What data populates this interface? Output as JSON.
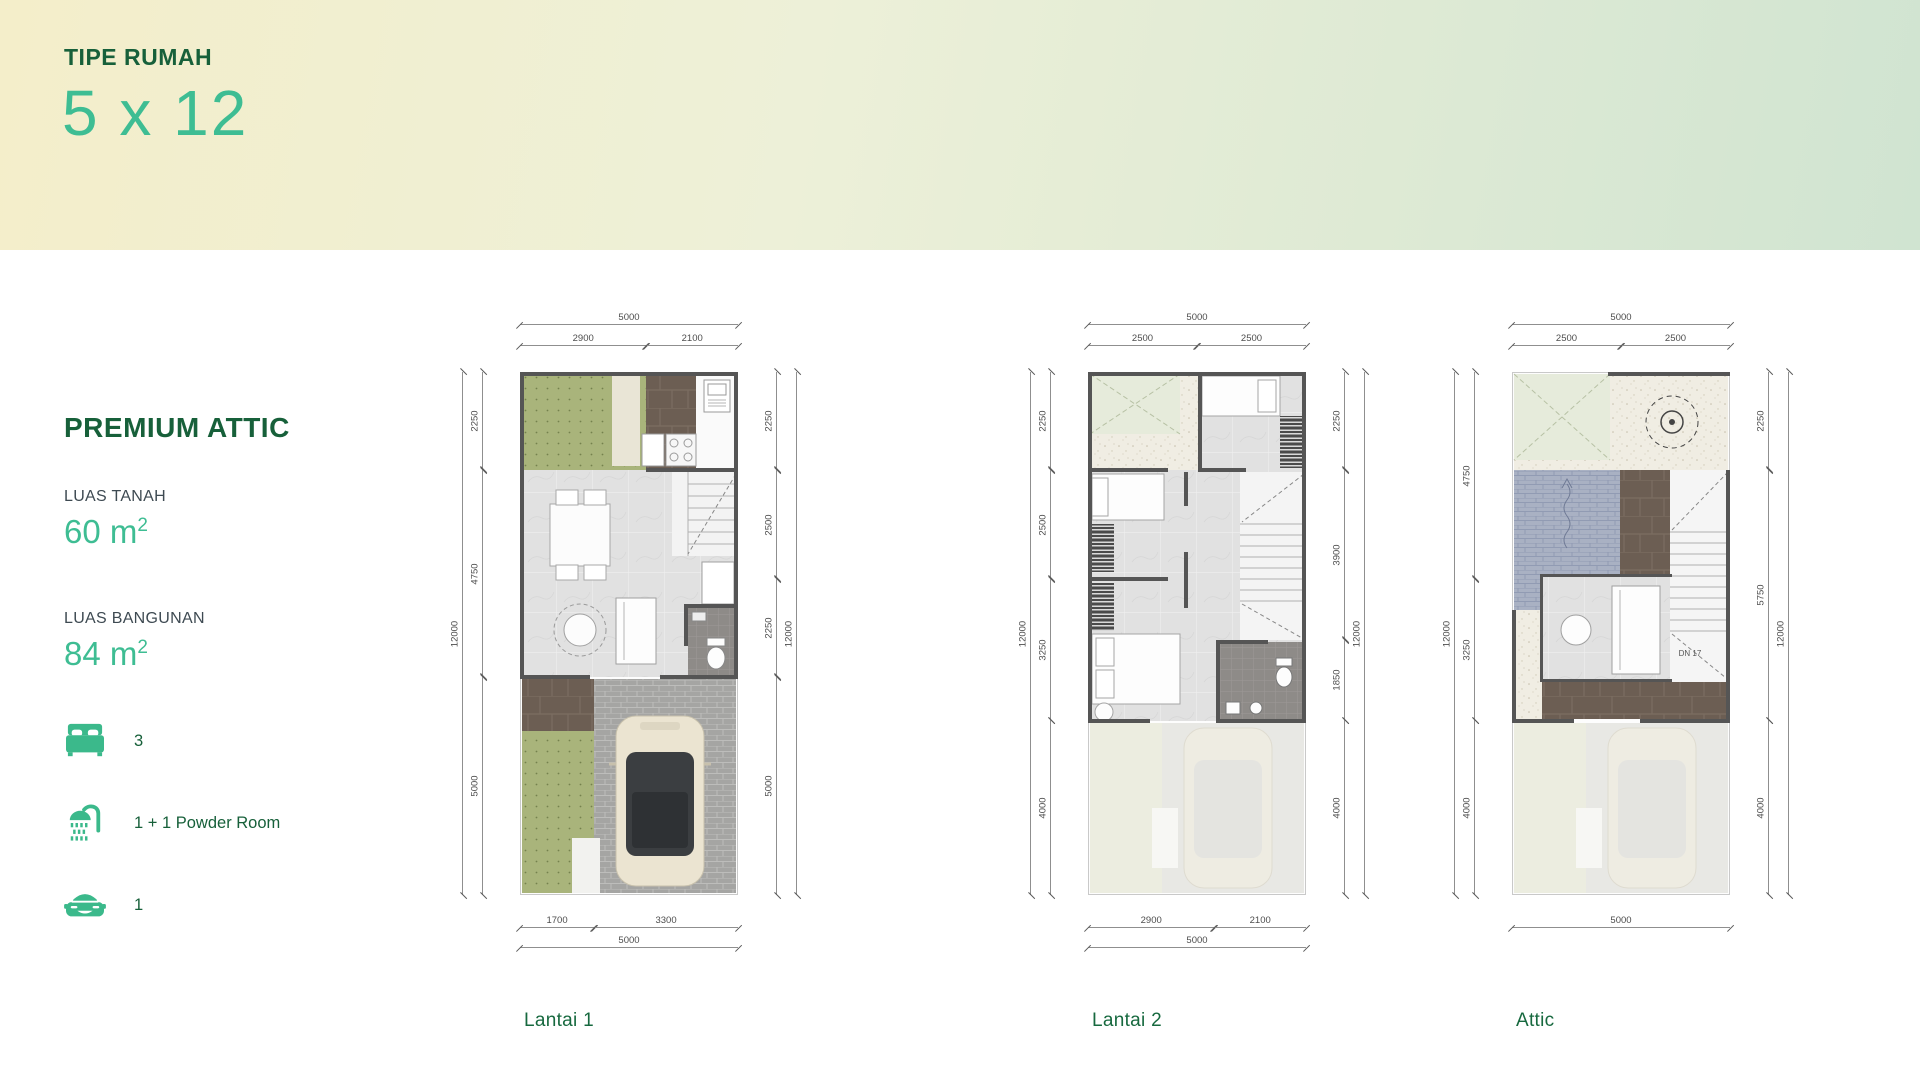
{
  "hero": {
    "eyebrow": "TIPE RUMAH",
    "title": "5 x 12"
  },
  "colors": {
    "dark_green": "#17603a",
    "teal": "#3ebd93",
    "icon_teal": "#3bb98b",
    "hero_gradient_left": "#f4eeca",
    "hero_gradient_right": "#d0e4d1"
  },
  "sidebar": {
    "title": "PREMIUM ATTIC",
    "specs": [
      {
        "label": "LUAS TANAH",
        "value": "60",
        "unit_base": "m",
        "unit_sup": "2"
      },
      {
        "label": "LUAS BANGUNAN",
        "value": "84",
        "unit_base": "m",
        "unit_sup": "2"
      }
    ],
    "features": [
      {
        "icon": "bed-icon",
        "label": "3"
      },
      {
        "icon": "shower-icon",
        "label": "1 + 1 Powder Room"
      },
      {
        "icon": "car-icon",
        "label": "1"
      }
    ]
  },
  "plans": [
    {
      "caption": "Lantai 1",
      "width_mm": 5000,
      "height_mm": 12000,
      "dims": {
        "top": {
          "total": "5000",
          "segments": [
            {
              "label": "2900",
              "mm": 2900
            },
            {
              "label": "2100",
              "mm": 2100
            }
          ]
        },
        "bottom": {
          "total": "5000",
          "segments": [
            {
              "label": "1700",
              "mm": 1700
            },
            {
              "label": "3300",
              "mm": 3300
            }
          ]
        },
        "left": {
          "total": "12000",
          "segments": [
            {
              "label": "2250",
              "mm": 2250
            },
            {
              "label": "4750",
              "mm": 4750
            },
            {
              "label": "5000",
              "mm": 5000
            }
          ]
        },
        "right": {
          "total": "12000",
          "segments": [
            {
              "label": "2250",
              "mm": 2250
            },
            {
              "label": "2500",
              "mm": 2500
            },
            {
              "label": "2250",
              "mm": 2250
            },
            {
              "label": "5000",
              "mm": 5000
            }
          ]
        }
      }
    },
    {
      "caption": "Lantai 2",
      "width_mm": 5000,
      "height_mm": 12000,
      "dims": {
        "top": {
          "total": "5000",
          "segments": [
            {
              "label": "2500",
              "mm": 2500
            },
            {
              "label": "2500",
              "mm": 2500
            }
          ]
        },
        "bottom": {
          "total": "5000",
          "segments": [
            {
              "label": "2900",
              "mm": 2900
            },
            {
              "label": "2100",
              "mm": 2100
            }
          ]
        },
        "left": {
          "total": "12000",
          "segments": [
            {
              "label": "2250",
              "mm": 2250
            },
            {
              "label": "2500",
              "mm": 2500
            },
            {
              "label": "3250",
              "mm": 3250
            },
            {
              "label": "4000",
              "mm": 4000
            }
          ]
        },
        "right": {
          "total": "12000",
          "segments": [
            {
              "label": "2250",
              "mm": 2250
            },
            {
              "label": "3900",
              "mm": 3900
            },
            {
              "label": "1850",
              "mm": 1850
            },
            {
              "label": "4000",
              "mm": 4000
            }
          ]
        }
      }
    },
    {
      "caption": "Attic",
      "stair_note": "DN 17",
      "width_mm": 5000,
      "height_mm": 12000,
      "dims": {
        "top": {
          "total": "5000",
          "segments": [
            {
              "label": "2500",
              "mm": 2500
            },
            {
              "label": "2500",
              "mm": 2500
            }
          ]
        },
        "bottom": {
          "total": "5000",
          "segments": []
        },
        "left": {
          "total": "12000",
          "segments": [
            {
              "label": "4750",
              "mm": 4750
            },
            {
              "label": "3250",
              "mm": 3250
            },
            {
              "label": "4000",
              "mm": 4000
            }
          ]
        },
        "right": {
          "total": "12000",
          "segments": [
            {
              "label": "2250",
              "mm": 2250
            },
            {
              "label": "5750",
              "mm": 5750
            },
            {
              "label": "4000",
              "mm": 4000
            }
          ]
        }
      }
    }
  ]
}
